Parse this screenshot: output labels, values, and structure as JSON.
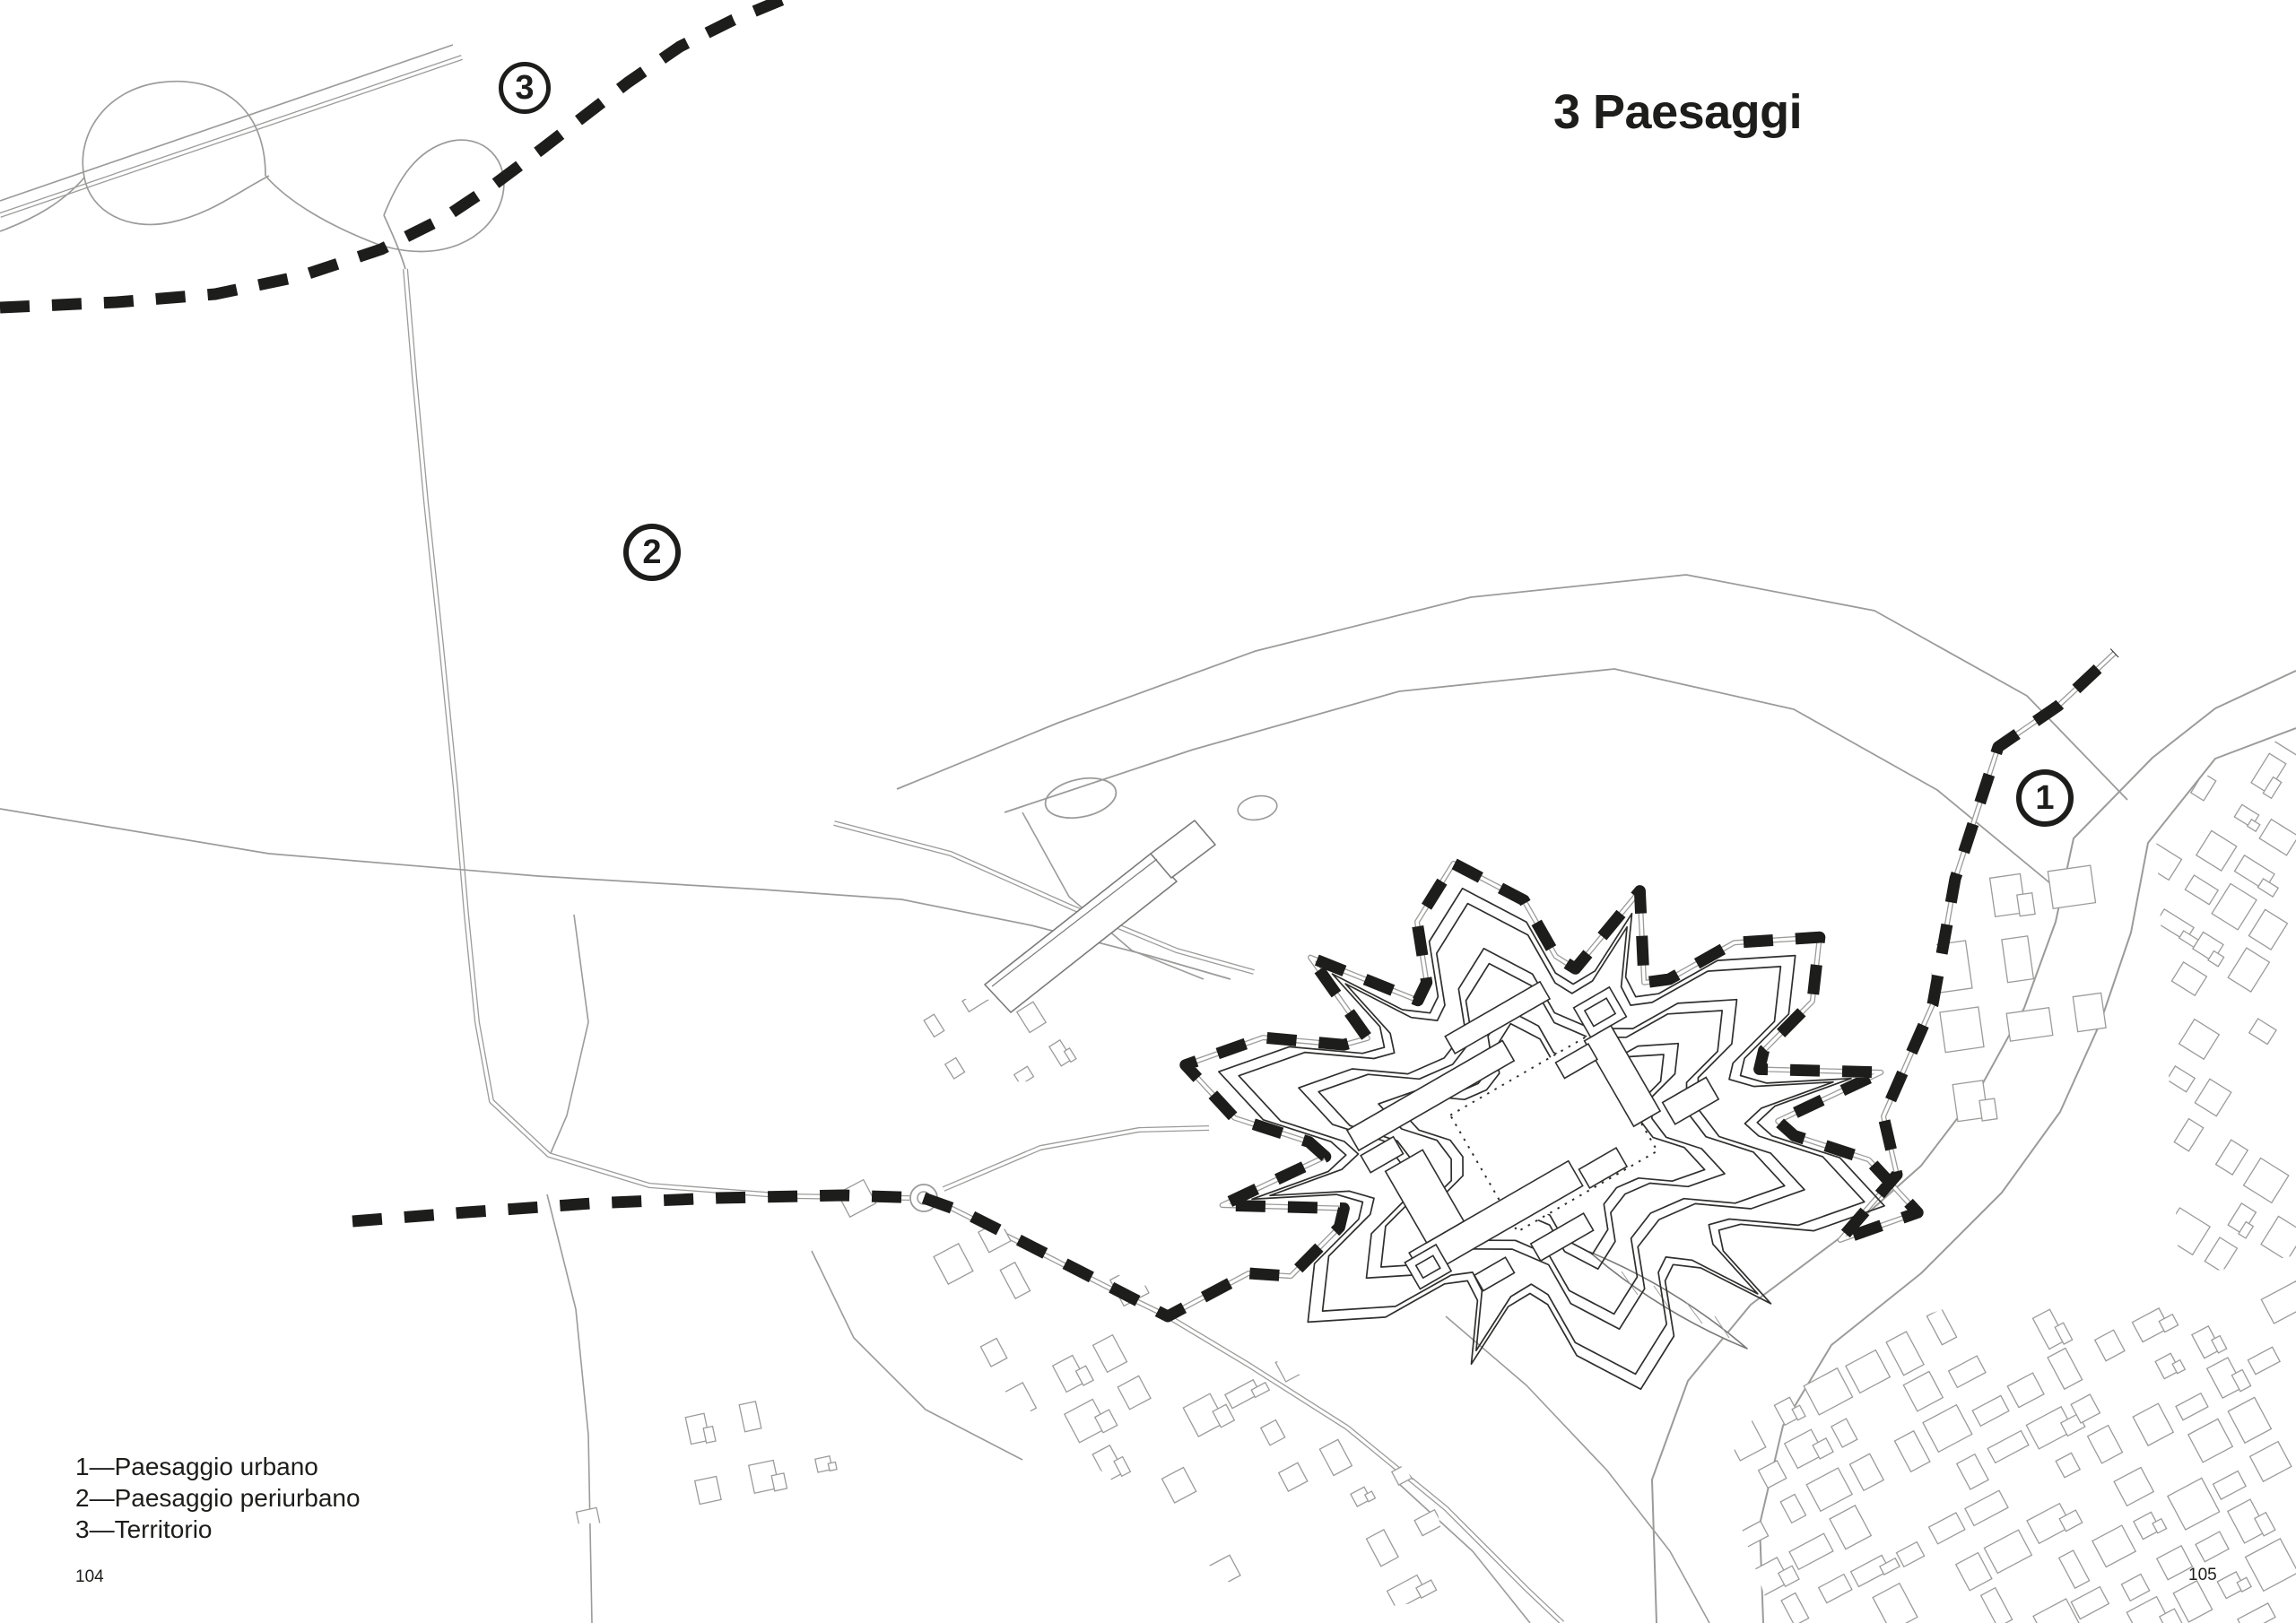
{
  "title": "3 Paesaggi",
  "legend": {
    "items": [
      {
        "text": "1—Paesaggio urbano"
      },
      {
        "text": "2—Paesaggio periurbano"
      },
      {
        "text": "3—Territorio"
      }
    ]
  },
  "markers": [
    {
      "label": "1"
    },
    {
      "label": "2"
    },
    {
      "label": "3"
    }
  ],
  "pages": {
    "left": "104",
    "right": "105"
  },
  "colors": {
    "ink": "#1d1d1b",
    "line": "#9b9b9a",
    "fort_line": "#2f2f2e"
  }
}
